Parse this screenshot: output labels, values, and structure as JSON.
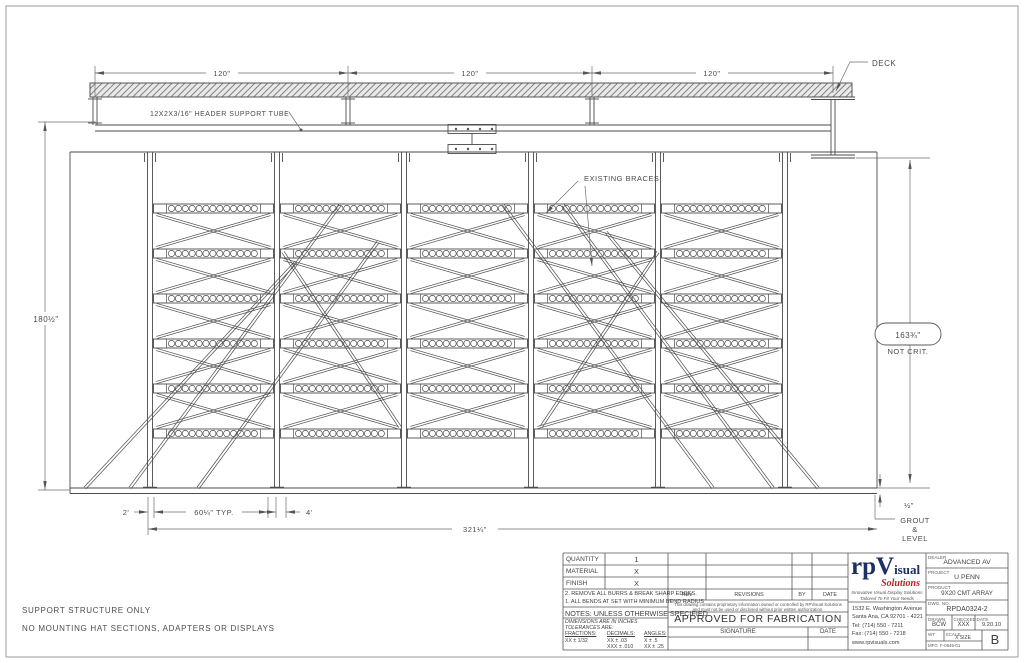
{
  "drawing": {
    "deck_label": "DECK",
    "header_tube_label": "12X2X3/16\" HEADER SUPPORT TUBE",
    "existing_braces_label": "EXISTING BRACES",
    "span_dims": [
      "120\"",
      "120\"",
      "120\""
    ],
    "height_dim_left": "180½\"",
    "height_dim_right": "163¾\"",
    "height_dim_right_note": "NOT CRIT.",
    "bottom_dims": {
      "offset_left": "2'",
      "bay_typ": "60¼\" TYP.",
      "gap": "4'",
      "overall": "321¼\""
    },
    "grout_gap": "½\"",
    "grout_note": [
      "GROUT",
      "&",
      "LEVEL"
    ]
  },
  "structure": {
    "columns": 6,
    "bays": 5,
    "beam_levels": 6
  },
  "footnotes": [
    "SUPPORT STRUCTURE ONLY",
    "NO MOUNTING HAT SECTIONS, ADAPTERS OR DISPLAYS"
  ],
  "title_block": {
    "bom": [
      {
        "label": "QUANTITY",
        "value": "1"
      },
      {
        "label": "MATERIAL",
        "value": "X"
      },
      {
        "label": "FINISH",
        "value": "X"
      }
    ],
    "notes": [
      "2. REMOVE ALL BURRS & BREAK SHARP EDGES.",
      "1. ALL BENDS AT SET WITH MINIMUM BEND RADIUS"
    ],
    "notes_header": "NOTES: UNLESS OTHERWISE SPECIFIED",
    "tolerance": {
      "line1": "DIMENSIONS ARE IN INCHES",
      "line2": "TOLERANCES ARE:",
      "fractions_label": "FRACTIONS:",
      "fractions_value": "XX ± 1/32",
      "decimals_label": "DECIMALS:",
      "decimals_value1": "XX ± .03",
      "decimals_value2": "XXX ± .010",
      "angles_label": "ANGLES:",
      "angles_value1": "X ± .5",
      "angles_value2": "XX ± .25"
    },
    "revision_table": {
      "rev": "REV",
      "revisions": "REVISIONS",
      "by": "BY",
      "date": "DATE"
    },
    "proprietary_note": "This drawing contains proprietary information owned or controlled by RPVisual Solutions and must not be used or disclosed without prior written authorization.",
    "approved": "APPROVED FOR FABRICATION",
    "signature_label": "SIGNATURE",
    "date_label": "DATE",
    "logo": {
      "rp": "rp",
      "v": "V",
      "isual": "isual",
      "solutions": "Solutions",
      "tagline1": "Innovative Visual Display Solutions",
      "tagline2": "Tailored To Fit Your Needs"
    },
    "address": [
      "1532 E. Washington Avenue",
      "Santa Ana, CA 92701 - 4221",
      "Tel: (714) 550 - 7211",
      "Fax: (714) 550 - 7218",
      "www.rpvisuals.com"
    ],
    "fields": {
      "dealer_label": "DEALER",
      "dealer": "ADVANCED AV",
      "project_label": "PROJECT",
      "project": "U PENN",
      "product_label": "PRODUCT",
      "product": "9X20 CMT ARRAY",
      "dwg_label": "DWG. NO.",
      "dwg": "RPDA0324-2",
      "drawn_label": "DRAWN",
      "drawn": "BCW",
      "checked_label": "CHECKED",
      "checked": "XXX",
      "date_label": "DATE",
      "date": "9.20.10",
      "wt_label": "WT",
      "wt_value": "",
      "scale_label": "SCALE",
      "scale_value": "X SIZE",
      "mfg_label": "MFG",
      "mfg_value": "F-0646-01",
      "rev": "B"
    },
    "colors": {
      "logo_navy": "#1e2f63",
      "logo_red": "#b5242a"
    }
  }
}
